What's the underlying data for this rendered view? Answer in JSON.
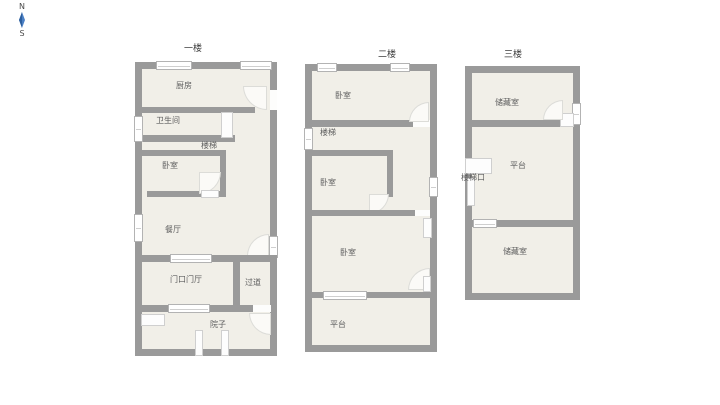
{
  "compass": {
    "north": "N",
    "south": "S"
  },
  "colors": {
    "wall": "#9a9a9a",
    "room_fill": "#f1efe8",
    "compass_blue": "#4a7fc4"
  },
  "floors": [
    {
      "title": "一楼",
      "rooms": {
        "kitchen": "厨房",
        "bathroom": "卫生间",
        "stairs": "楼梯",
        "bedroom": "卧室",
        "dining": "餐厅",
        "entry": "门口门厅",
        "corridor": "过道",
        "yard": "院子"
      }
    },
    {
      "title": "二楼",
      "rooms": {
        "bedroom1": "卧室",
        "stairs": "楼梯",
        "bedroom2": "卧室",
        "bedroom3": "卧室",
        "terrace": "平台"
      }
    },
    {
      "title": "三楼",
      "rooms": {
        "storage1": "储藏室",
        "terrace": "平台",
        "stair_entry": "楼梯口",
        "storage2": "储藏室"
      }
    }
  ]
}
